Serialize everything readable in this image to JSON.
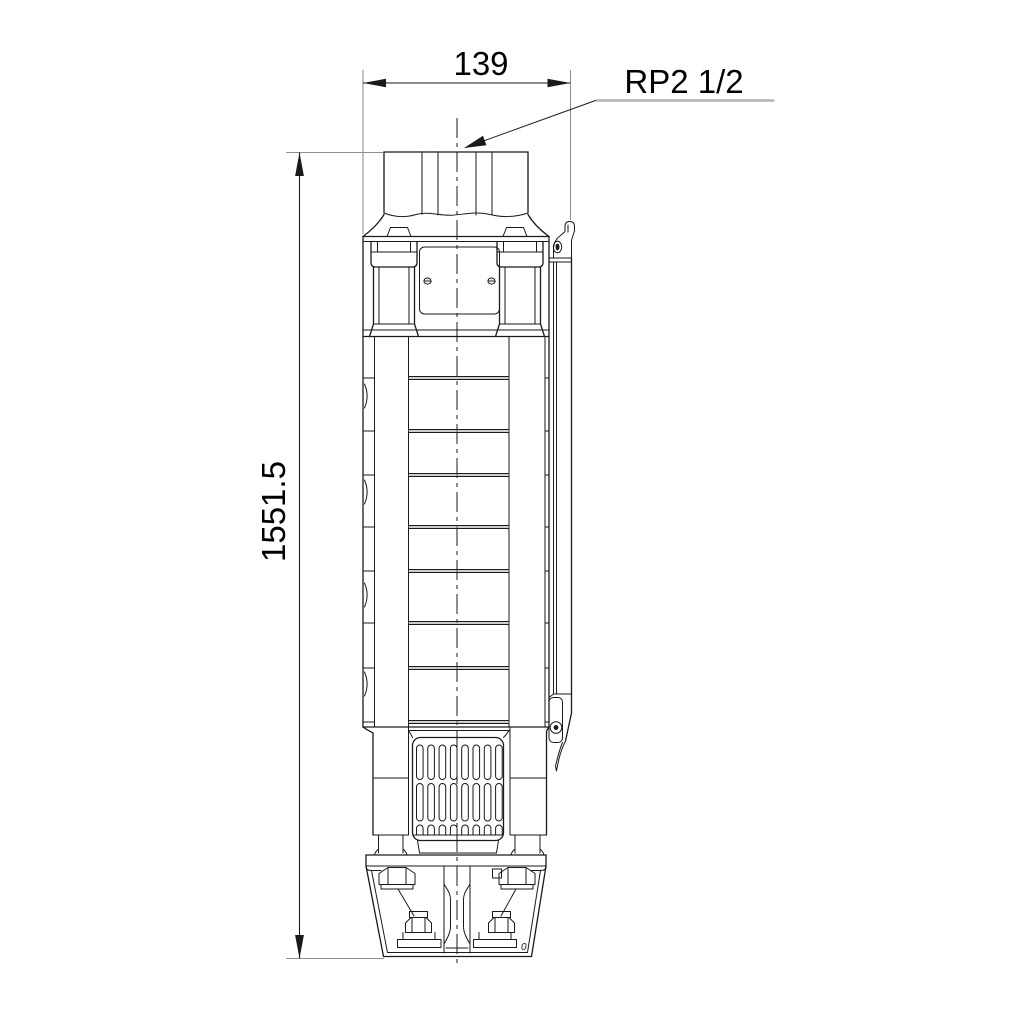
{
  "drawing": {
    "type": "technical-dimensional-drawing",
    "subject": "submersible borehole pump, front elevation",
    "background_color": "#ffffff",
    "line_color": "#1a1a1a",
    "extension_line_color": "#8f8f8f",
    "leader_line_color": "#b3b3b3",
    "dimensions": {
      "width": {
        "label": "139",
        "orientation": "horizontal"
      },
      "height": {
        "label": "1551.5",
        "orientation": "vertical"
      }
    },
    "connection": {
      "label": "RP2 1/2"
    },
    "mark": {
      "label": "0"
    }
  }
}
